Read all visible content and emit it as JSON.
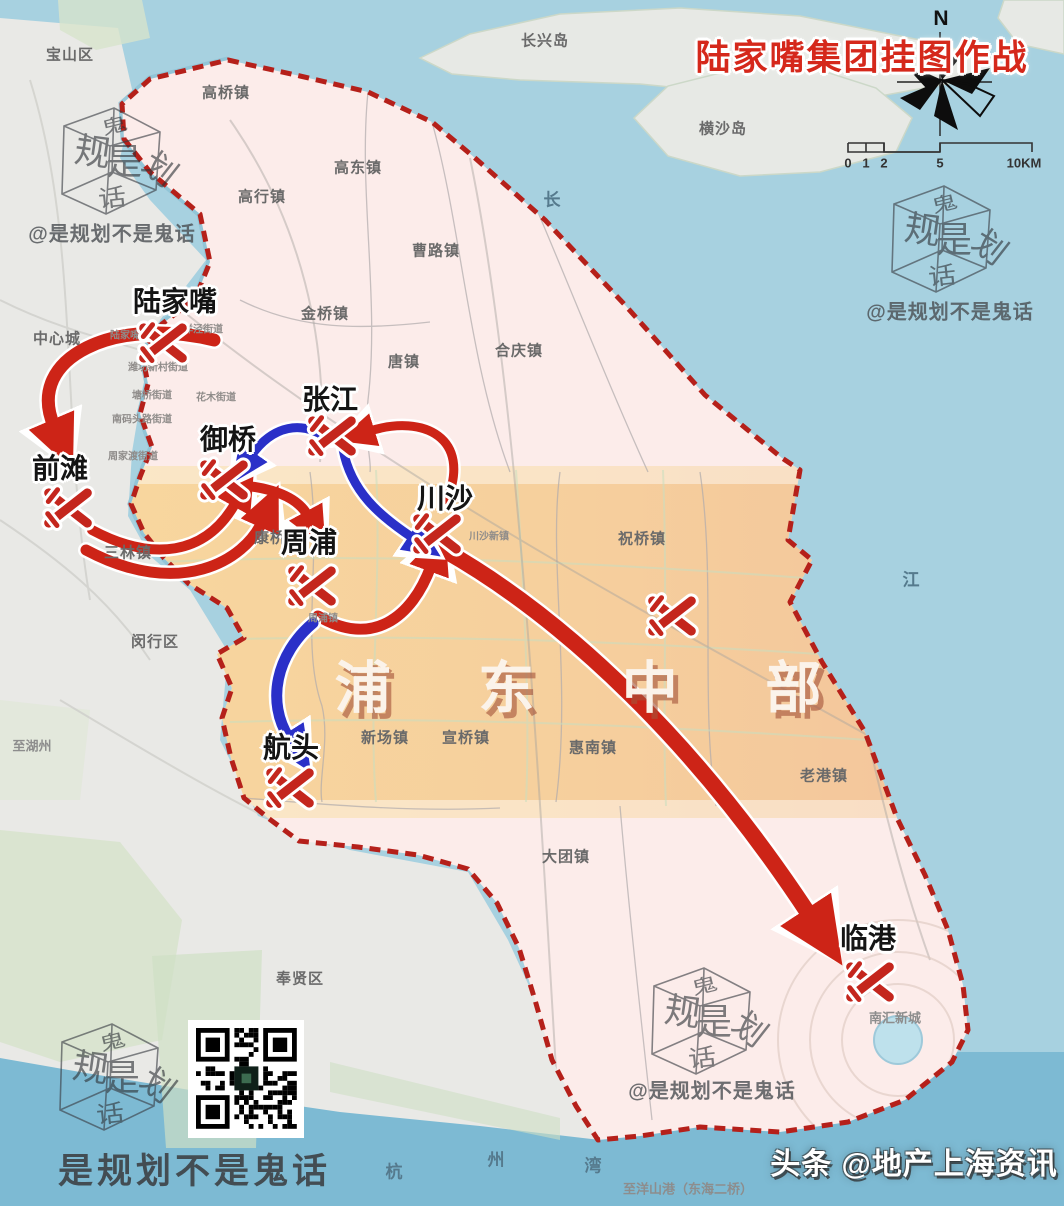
{
  "title": "陆家嘴集团挂图作战",
  "compass": {
    "n": "N"
  },
  "scalebar": {
    "labels": [
      {
        "t": "0",
        "x": 848,
        "y": 163
      },
      {
        "t": "1",
        "x": 866,
        "y": 163
      },
      {
        "t": "2",
        "x": 884,
        "y": 163
      },
      {
        "t": "5",
        "x": 940,
        "y": 163
      },
      {
        "t": "10KM",
        "x": 1024,
        "y": 163
      }
    ]
  },
  "region_label": {
    "text": "浦 东 中 部",
    "x": 596,
    "y": 684
  },
  "markers": [
    {
      "label": "陆家嘴",
      "x": 163,
      "y": 343,
      "lx": 175,
      "ly": 300
    },
    {
      "label": "前滩",
      "x": 68,
      "y": 508,
      "lx": 60,
      "ly": 467
    },
    {
      "label": "御桥",
      "x": 224,
      "y": 480,
      "lx": 228,
      "ly": 438
    },
    {
      "label": "张江",
      "x": 332,
      "y": 436,
      "lx": 330,
      "ly": 398
    },
    {
      "label": "周浦",
      "x": 312,
      "y": 586,
      "lx": 309,
      "ly": 541
    },
    {
      "label": "川沙",
      "x": 437,
      "y": 534,
      "lx": 445,
      "ly": 497
    },
    {
      "label": "航头",
      "x": 290,
      "y": 788,
      "lx": 291,
      "ly": 746
    },
    {
      "label": "临港",
      "x": 870,
      "y": 982,
      "lx": 868,
      "ly": 937
    },
    {
      "label": "",
      "x": 672,
      "y": 616,
      "lx": 0,
      "ly": 0
    }
  ],
  "town_labels": [
    {
      "t": "宝山区",
      "x": 70,
      "y": 54,
      "c": "town"
    },
    {
      "t": "长兴岛",
      "x": 545,
      "y": 40,
      "c": "town"
    },
    {
      "t": "横沙岛",
      "x": 723,
      "y": 128,
      "c": "town"
    },
    {
      "t": "高桥镇",
      "x": 226,
      "y": 92,
      "c": "town"
    },
    {
      "t": "高东镇",
      "x": 358,
      "y": 167,
      "c": "town"
    },
    {
      "t": "高行镇",
      "x": 262,
      "y": 196,
      "c": "town"
    },
    {
      "t": "曹路镇",
      "x": 436,
      "y": 250,
      "c": "town"
    },
    {
      "t": "金桥镇",
      "x": 325,
      "y": 313,
      "c": "town"
    },
    {
      "t": "唐镇",
      "x": 404,
      "y": 361,
      "c": "town"
    },
    {
      "t": "合庆镇",
      "x": 519,
      "y": 350,
      "c": "town"
    },
    {
      "t": "中心城",
      "x": 57,
      "y": 338,
      "c": "town"
    },
    {
      "t": "祝桥镇",
      "x": 642,
      "y": 538,
      "c": "town"
    },
    {
      "t": "三林镇",
      "x": 128,
      "y": 552,
      "c": "town"
    },
    {
      "t": "康桥镇",
      "x": 278,
      "y": 537,
      "c": "town"
    },
    {
      "t": "闵行区",
      "x": 155,
      "y": 641,
      "c": "town"
    },
    {
      "t": "新场镇",
      "x": 385,
      "y": 737,
      "c": "town"
    },
    {
      "t": "宣桥镇",
      "x": 466,
      "y": 737,
      "c": "town"
    },
    {
      "t": "惠南镇",
      "x": 593,
      "y": 747,
      "c": "town"
    },
    {
      "t": "老港镇",
      "x": 824,
      "y": 775,
      "c": "town"
    },
    {
      "t": "大团镇",
      "x": 566,
      "y": 856,
      "c": "town"
    },
    {
      "t": "奉贤区",
      "x": 300,
      "y": 978,
      "c": "town"
    },
    {
      "t": "南汇新城",
      "x": 895,
      "y": 1017,
      "c": "faint"
    },
    {
      "t": "至湖州",
      "x": 32,
      "y": 745,
      "c": "faint"
    },
    {
      "t": "长",
      "x": 553,
      "y": 198,
      "c": "sea"
    },
    {
      "t": "江",
      "x": 912,
      "y": 578,
      "c": "sea"
    },
    {
      "t": "杭",
      "x": 395,
      "y": 1170,
      "c": "sea"
    },
    {
      "t": "州",
      "x": 497,
      "y": 1158,
      "c": "sea"
    },
    {
      "t": "湾",
      "x": 594,
      "y": 1164,
      "c": "sea"
    },
    {
      "t": "至洋山港（东海二桥）",
      "x": 688,
      "y": 1188,
      "c": "faint"
    }
  ],
  "street_labels": [
    {
      "t": "陆家嘴街道",
      "x": 135,
      "y": 334
    },
    {
      "t": "洋泾街道",
      "x": 203,
      "y": 328
    },
    {
      "t": "潍坊新村街道",
      "x": 158,
      "y": 366
    },
    {
      "t": "塘桥街道",
      "x": 152,
      "y": 394
    },
    {
      "t": "花木街道",
      "x": 216,
      "y": 396
    },
    {
      "t": "南码头路街道",
      "x": 142,
      "y": 418
    },
    {
      "t": "周家渡街道",
      "x": 133,
      "y": 455
    },
    {
      "t": "川沙新镇",
      "x": 489,
      "y": 535
    },
    {
      "t": "周浦镇",
      "x": 323,
      "y": 617
    }
  ],
  "arrows": {
    "red_color": "#cd2417",
    "blue_color": "#2a30c8",
    "red": [
      {
        "d": "M 214,340 C 118,316 24,356 54,426",
        "w": 13
      },
      {
        "d": "M 92,530 C 152,562 206,556 236,502",
        "w": 10
      },
      {
        "d": "M 86,550 C 180,600 245,560 262,522",
        "w": 11
      },
      {
        "d": "M 248,486 Q 295,492 308,516",
        "w": 10
      },
      {
        "d": "M 318,616 C 372,648 412,618 431,566",
        "w": 11
      },
      {
        "d": "M 447,500 C 472,438 424,414 370,431",
        "w": 9
      },
      {
        "d": "M 444,550 C 564,618 696,742 810,916",
        "w": 16
      }
    ],
    "blue": [
      {
        "d": "M 331,441 C 302,418 272,426 251,456",
        "w": 9
      },
      {
        "d": "M 343,449 C 351,492 380,516 413,538",
        "w": 9
      },
      {
        "d": "M 313,623 C 276,654 266,702 289,738",
        "w": 11
      }
    ]
  },
  "watermark": {
    "handle": "@是规划不是鬼话",
    "cube_chars": [
      "鬼",
      "规",
      "是",
      "划",
      "话"
    ],
    "cubes": [
      {
        "x": 108,
        "y": 162
      },
      {
        "x": 938,
        "y": 240
      },
      {
        "x": 698,
        "y": 1022
      },
      {
        "x": 106,
        "y": 1078
      }
    ],
    "handles": [
      {
        "x": 112,
        "y": 232
      },
      {
        "x": 950,
        "y": 310
      },
      {
        "x": 712,
        "y": 1089
      }
    ],
    "footer_text": "是规划不是鬼话",
    "credit_text": "头条 @地产上海资讯"
  },
  "colors": {
    "sea": "#a7d1e0",
    "bay": "#6fb2cf",
    "west_land": "#e9e9e6",
    "pudong_pink": "#fcecea",
    "band_west": "#f8d89e",
    "band_east": "#f2c29b",
    "border_red": "#b5201a",
    "marker_red": "#c4261d",
    "title_red": "#d5281b"
  }
}
